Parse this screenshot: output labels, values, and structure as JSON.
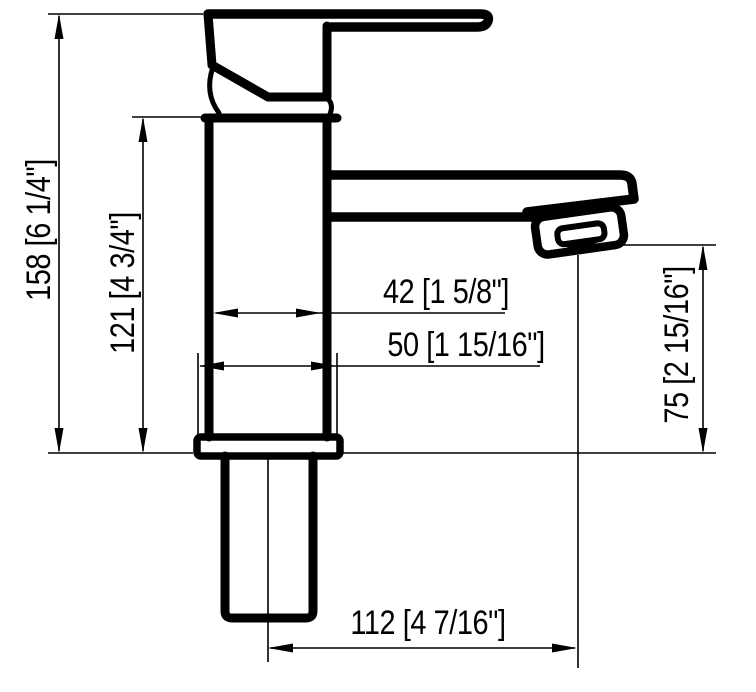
{
  "drawing": {
    "kind": "technical-dimension-drawing",
    "subject": "single-lever basin faucet, side elevation",
    "background_color": "#ffffff",
    "line_color": "#000000",
    "dimensions": {
      "total_height": "158 [6 1/4\"]",
      "body_height": "121 [4 3/4\"]",
      "body_width": "42 [1 5/8\"]",
      "base_width": "50 [1 15/16\"]",
      "spout_clearance": "75 [2 15/16\"]",
      "spout_reach": "112 [4 7/16\"]"
    }
  }
}
